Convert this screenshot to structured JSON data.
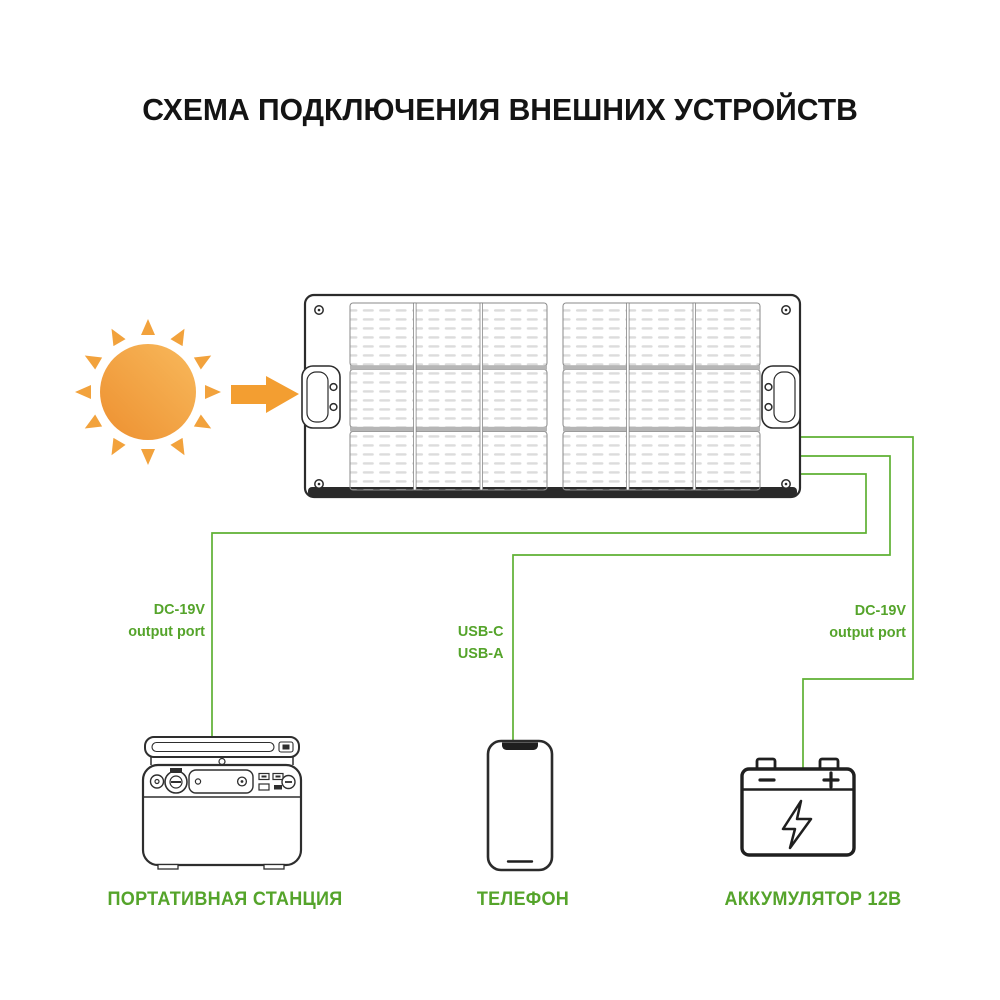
{
  "title": "СХЕМА ПОДКЛЮЧЕНИЯ ВНЕШНИХ УСТРОЙСТВ",
  "colors": {
    "accent_green": "#55a42b",
    "wire_green": "#5fb133",
    "sun_orange": "#f09334",
    "sun_orange_light": "#f8b95c",
    "outline_dark": "#2b2b2b"
  },
  "ports": {
    "station": {
      "line1": "DC-19V",
      "line2": "output port"
    },
    "phone": {
      "line1": "USB-C",
      "line2": "USB-A"
    },
    "battery": {
      "line1": "DC-19V",
      "line2": "output port"
    }
  },
  "devices": {
    "solar_panel": {
      "name": "солнечная панель"
    },
    "station": {
      "label": "ПОРТАТИВНАЯ СТАНЦИЯ"
    },
    "phone": {
      "label": "ТЕЛЕФОН"
    },
    "battery": {
      "label": "АККУМУЛЯТОР 12В"
    }
  },
  "icons": {
    "sun": "sun-icon",
    "arrow": "arrow-right-icon",
    "lightning": "lightning-bolt-icon"
  }
}
